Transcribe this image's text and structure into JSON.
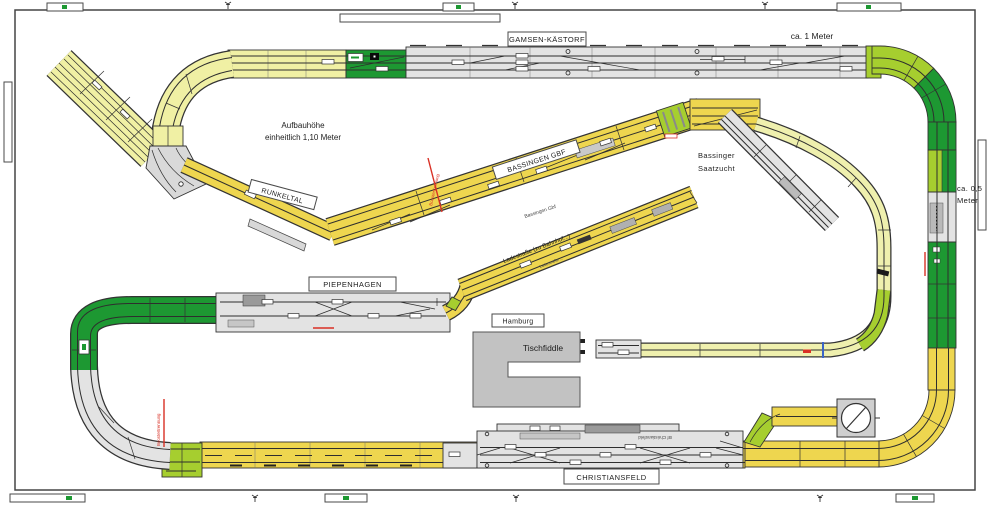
{
  "stations": {
    "gamsen": "GAMSEN-KÄSTORF",
    "bassingen": "BASSINGEN GBF",
    "runkeltal": "RUNKELTAL",
    "piepenhagen": "PIEPENHAGEN",
    "christiansfeld": "CHRISTIANSFELD",
    "hamburg": "Hamburg",
    "tischfiddle": "Tischfiddle"
  },
  "annotations": {
    "aufbau_line1": "Aufbauhöhe",
    "aufbau_line2": "einheitlich 1,10 Meter",
    "ca_1_meter": "ca. 1 Meter",
    "ca_05_line1": "ca. 0,5",
    "ca_05_line2": "Meter",
    "saatzucht_line1": "Bassinger",
    "saatzucht_line2": "Saatzucht",
    "ladestrasse": "Ladestraße (zu Bahnhof...)",
    "ladestrasse_small": "Ladestraße ...",
    "bassingen_small": "Bassingen Gbf",
    "christiansfeld_small": "Bf Christiansfeld",
    "booster_1": "Boostertrennung",
    "booster_2": "Boostertrennung"
  },
  "colors": {
    "trackYellow": "#eed64f",
    "paleYellow": "#f0f0a4",
    "paleLine": "#eff0ae",
    "darkGreen": "#1d9832",
    "chartreuse": "#a6ce2f",
    "stationGray": "#e3e3e3",
    "buildingGray": "#c2c2c2",
    "boosterRed": "#d93025",
    "markerBlue": "#3a64c8",
    "trackLine": "#2e2e2e"
  }
}
